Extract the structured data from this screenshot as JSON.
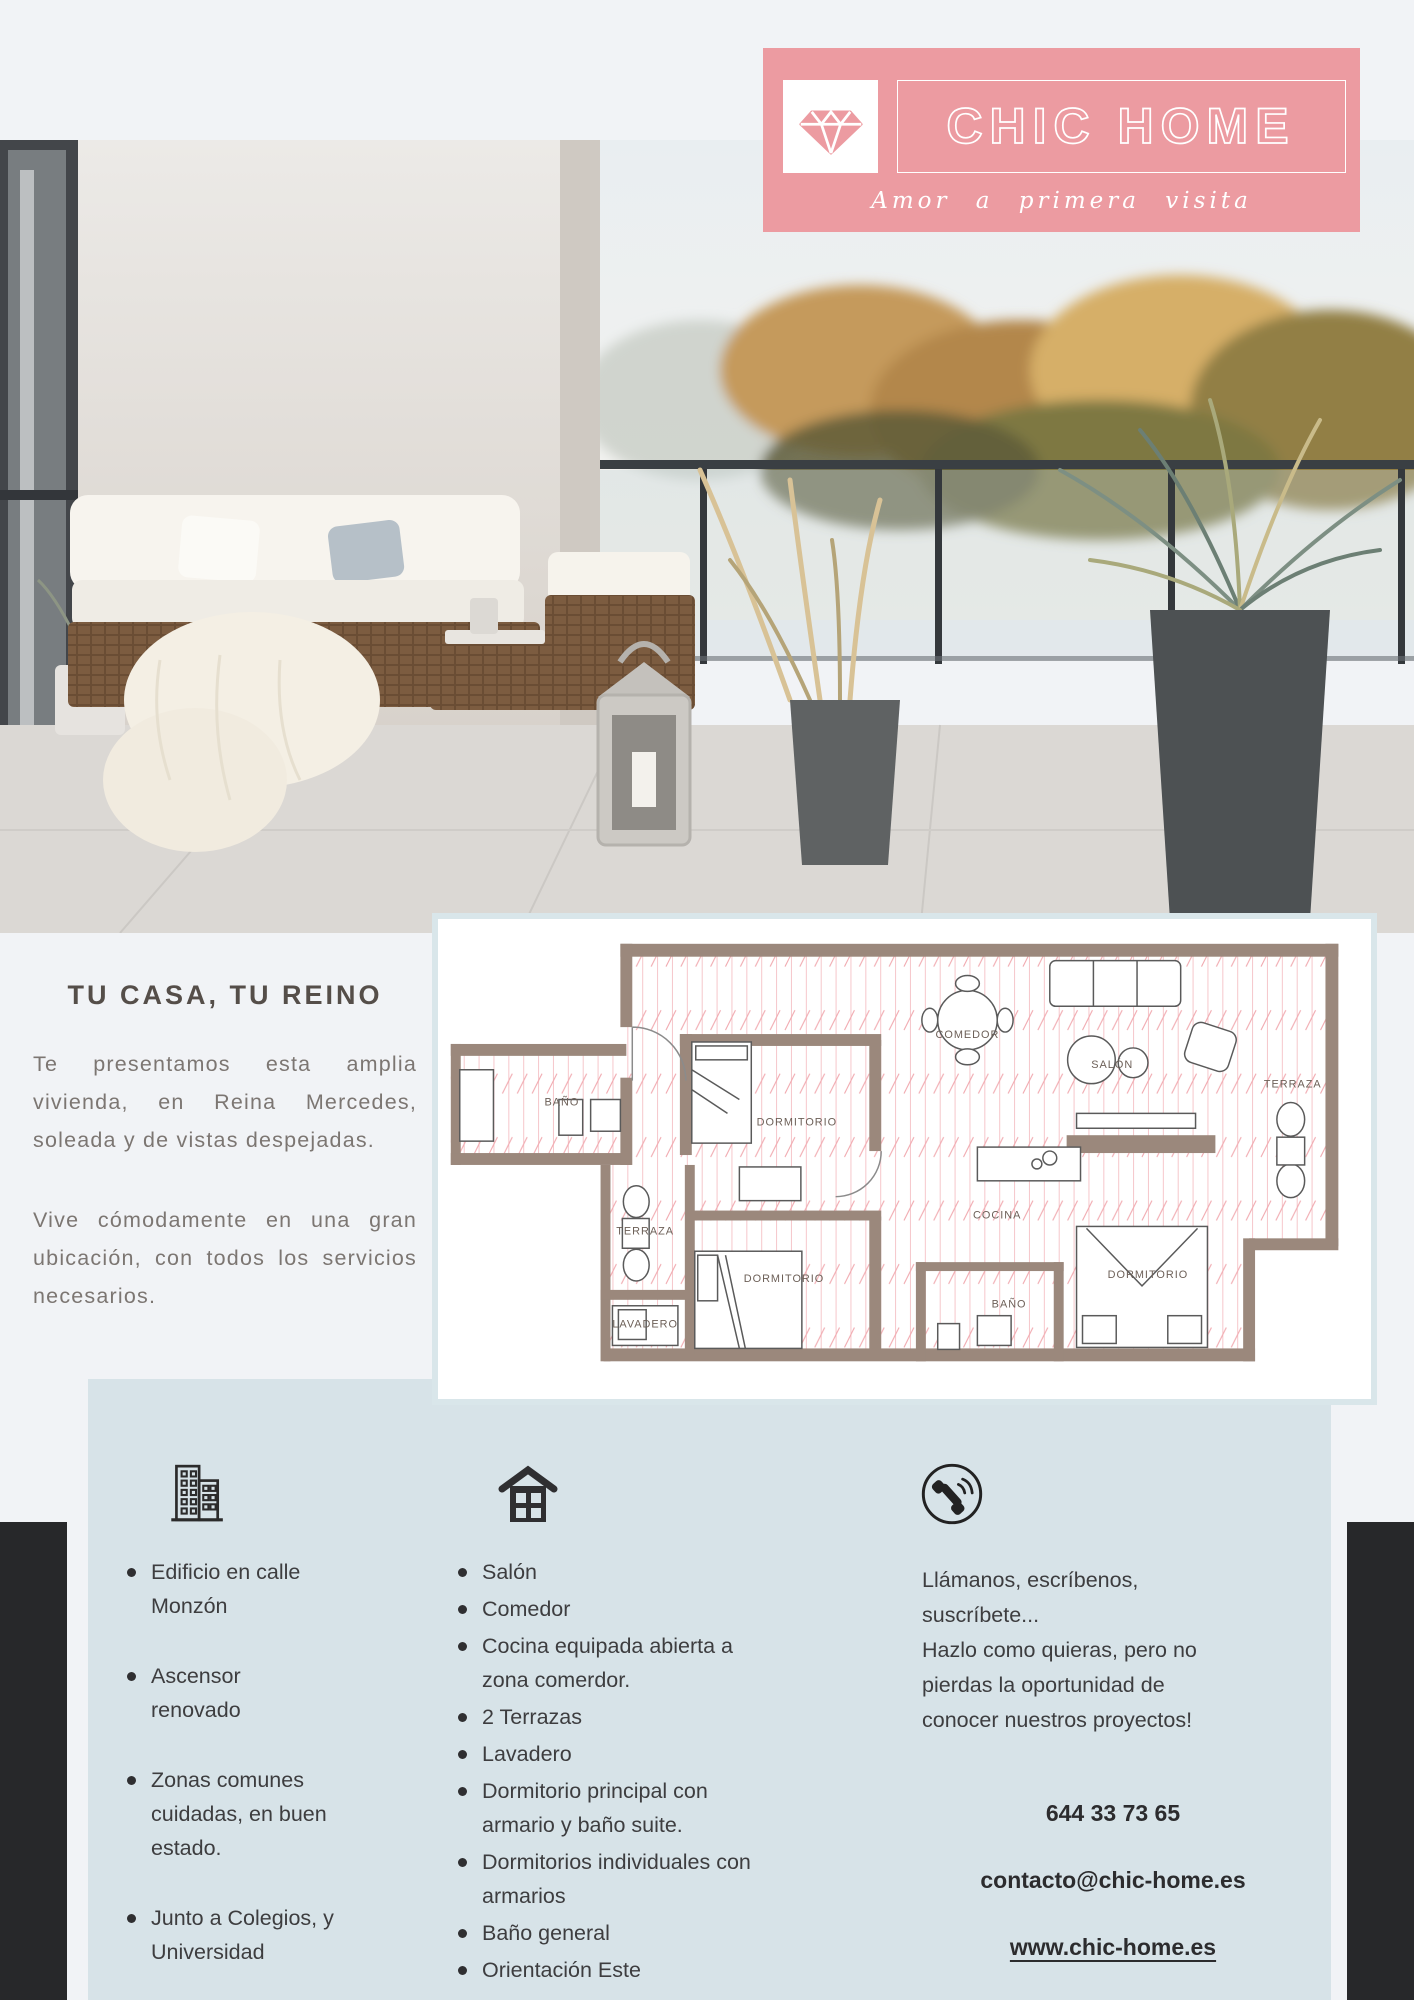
{
  "brand": {
    "name": "CHIC HOME",
    "tagline": "Amor a primera visita",
    "logo_icon": "diamond-icon",
    "banner_color": "#ec9ba1"
  },
  "intro": {
    "heading": "TU CASA, TU REINO",
    "paragraphs": [
      "Te presentamos esta amplia vivienda, en Reina Mercedes, soleada y de vistas despejadas.",
      "Vive cómodamente en una gran ubicación, con todos los servicios necesarios."
    ]
  },
  "floorplan": {
    "rooms": [
      "BAÑO",
      "DORMITORIO",
      "COMEDOR",
      "SALÓN",
      "TERRAZA",
      "TERRAZA",
      "COCINA",
      "DORMITORIO",
      "LAVADERO",
      "BAÑO",
      "DORMITORIO"
    ],
    "wall_color": "#9b887c",
    "hatch_color": "#f2b9be"
  },
  "features": {
    "building": {
      "icon": "building-icon",
      "items": [
        "Edificio en calle\nMonzón",
        "Ascensor\nrenovado",
        "Zonas comunes\ncuidadas, en buen\nestado.",
        "Junto a Colegios, y\nUniversidad"
      ]
    },
    "interior": {
      "icon": "house-icon",
      "items": [
        "Salón",
        "Comedor",
        "Cocina equipada abierta a\nzona comerdor.",
        "2 Terrazas",
        "Lavadero",
        "Dormitorio principal con\narmario y baño suite.",
        "Dormitorios individuales con\narmarios",
        "Baño general",
        "Orientación Este"
      ]
    },
    "contact": {
      "icon": "phone-icon",
      "line1": "Llámanos, escríbenos,\nsuscríbete...",
      "line2": "Hazlo como quieras, pero no\npierdas la oportunidad de\nconocer nuestros proyectos!",
      "phone": "644 33 73 65",
      "email": "contacto@chic-home.es",
      "website": "www.chic-home.es"
    }
  },
  "colors": {
    "banner_pink": "#ec9ba1",
    "panel_blue": "#d7e3e8",
    "dark_corner": "#27282a",
    "page_bg": "#f1f3f6"
  }
}
